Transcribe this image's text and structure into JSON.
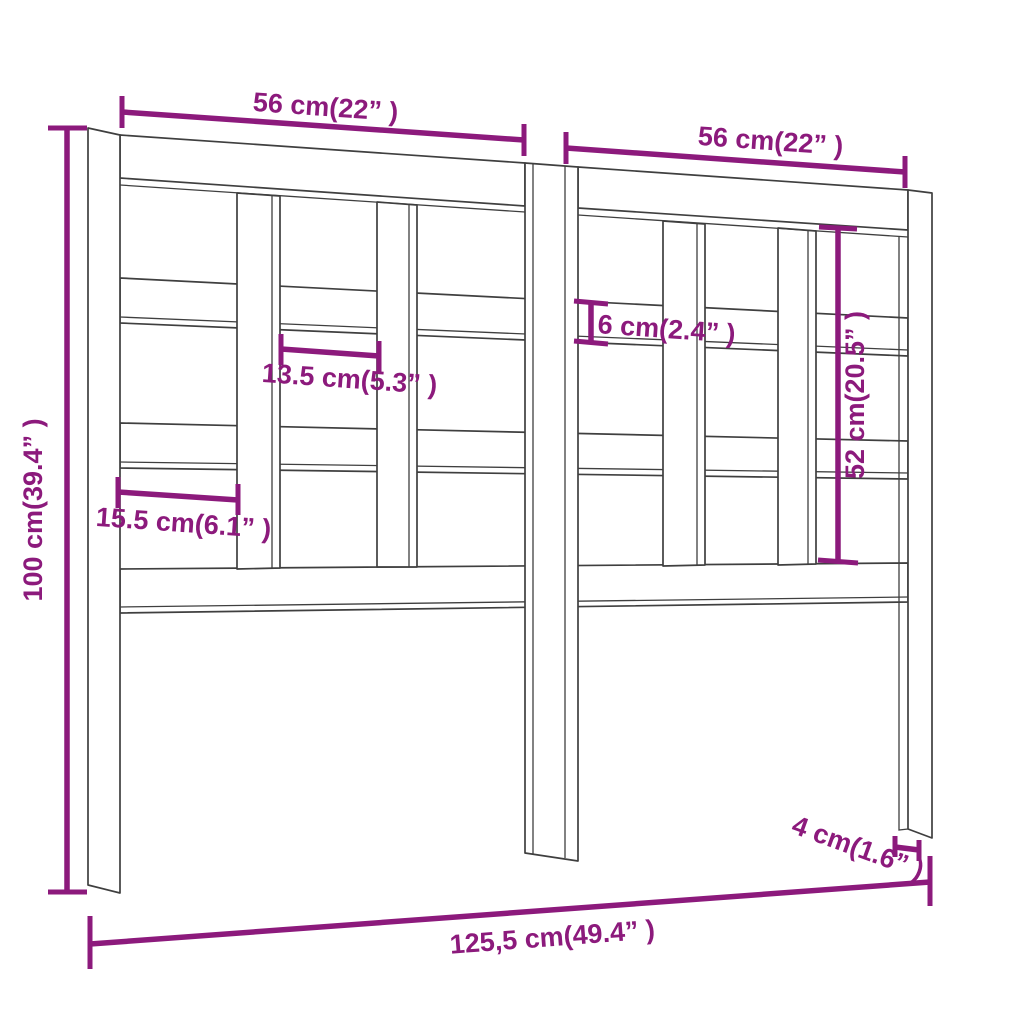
{
  "diagram": {
    "type": "product-dimension-diagram",
    "subject": "wooden-slatted-headboard-front-view",
    "colors": {
      "dimension": "#8C1A7C",
      "line": "#3F3F3F",
      "background": "#FFFFFF"
    },
    "dimensions": [
      {
        "id": "width-left-section",
        "label": "56 cm(22” )"
      },
      {
        "id": "width-right-section",
        "label": "56 cm(22” )"
      },
      {
        "id": "height-overall",
        "label": "100 cm(39.4” )"
      },
      {
        "id": "gap-first",
        "label": "15.5 cm(6.1” )"
      },
      {
        "id": "gap-inner",
        "label": "13.5 cm(5.3” )"
      },
      {
        "id": "slat-thickness",
        "label": "6 cm(2.4” )"
      },
      {
        "id": "panel-opening-height",
        "label": "52 cm(20.5” )"
      },
      {
        "id": "leg-thickness",
        "label": "4 cm(1.6” )"
      },
      {
        "id": "width-overall",
        "label": "125,5 cm(49.4” )"
      }
    ]
  }
}
